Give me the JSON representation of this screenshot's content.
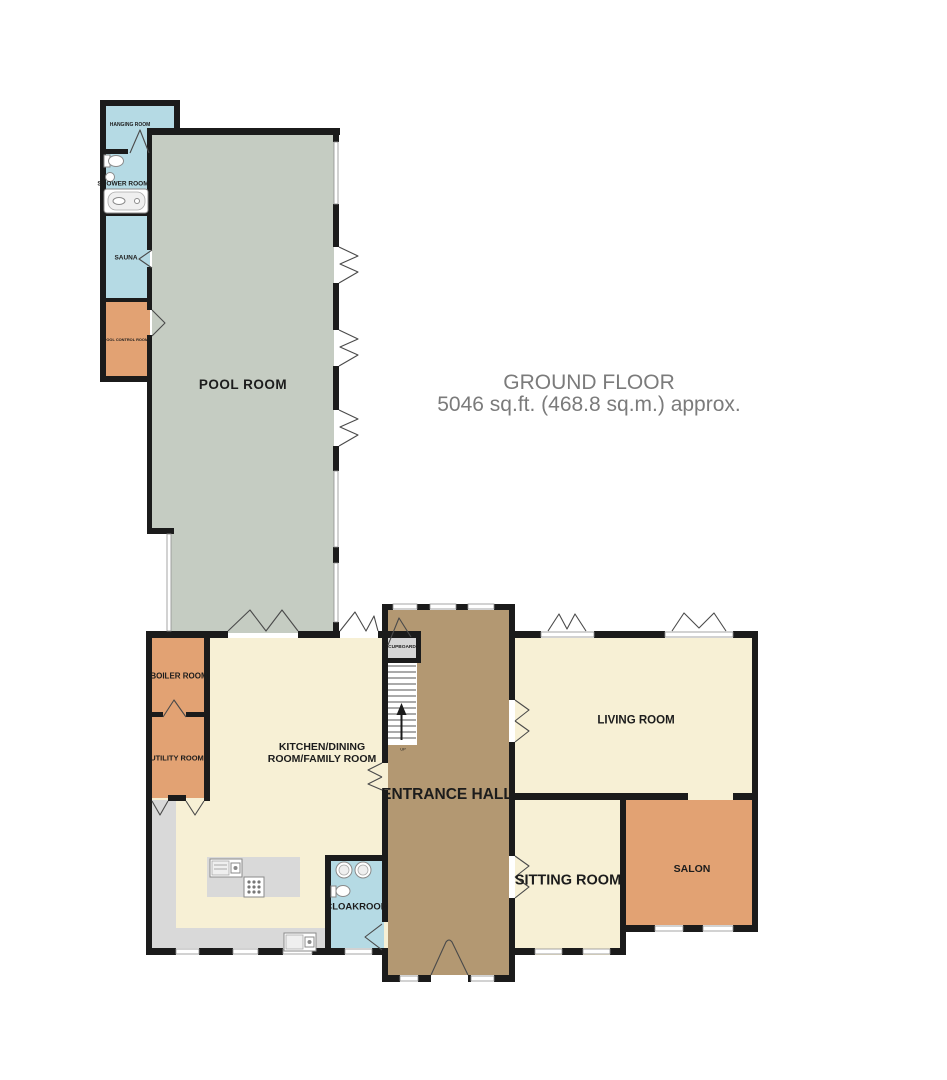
{
  "title": {
    "floor": "GROUND FLOOR",
    "area": "5046 sq.ft. (468.8 sq.m.) approx."
  },
  "rooms": {
    "hanging_room": "HANGING ROOM",
    "shower_room": "SHOWER ROOM",
    "sauna": "SAUNA",
    "pool_control_room": "POOL CONTROL ROOM",
    "pool_room": "POOL ROOM",
    "boiler_room": "BOILER ROOM",
    "utility_room": "UTILITY ROOM",
    "kitchen_line1": "KITCHEN/DINING",
    "kitchen_line2": "ROOM/FAMILY ROOM",
    "cupboard": "CUPBOARD",
    "entrance_hall": "ENTRANCE HALL",
    "living_room": "LIVING ROOM",
    "sitting_room": "SITTING ROOM",
    "salon": "SALON",
    "cloakroom": "CLOAKROOM"
  },
  "stairs": {
    "up_label": "UP"
  },
  "colors": {
    "wall": "#1b1b1b",
    "pool_room": "#c5ccc2",
    "wet_rooms": "#b5dae4",
    "service_rooms": "#e2a273",
    "living_areas": "#f7f0d5",
    "entrance_hall": "#b39872",
    "counters": "#d9d9d9",
    "cupboard": "#d6d6d6",
    "title_text": "#7b7b7b"
  }
}
